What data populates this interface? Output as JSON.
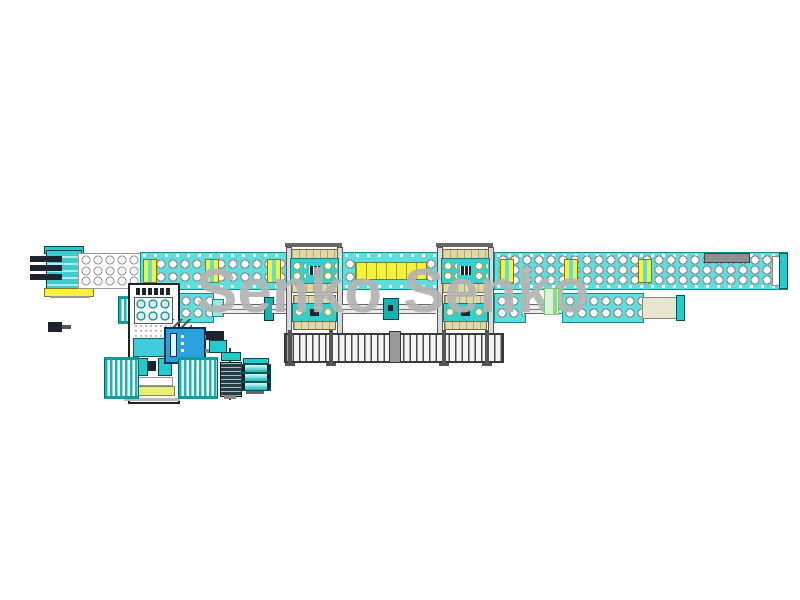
{
  "watermark": {
    "text": "Senko Senko"
  },
  "colors": {
    "teal-band": "#5fdede",
    "teal-dark": "#0b8f8f",
    "teal-mid": "#35cfcf",
    "cyan-bright": "#18b6b6",
    "yellow": "#f6f23a",
    "beige": "#ded7a6",
    "cabinet-blue": "#2aa0dc",
    "watermark-gray": "#b4b4b4",
    "logo-green": "#d9f2d9",
    "logo-stripe": "#8fd48f",
    "dark-navy": "#1d2430"
  },
  "icons": {
    "roller": "circle-glyph",
    "coupler": "yellow-block",
    "ladder": "rung-pattern"
  }
}
